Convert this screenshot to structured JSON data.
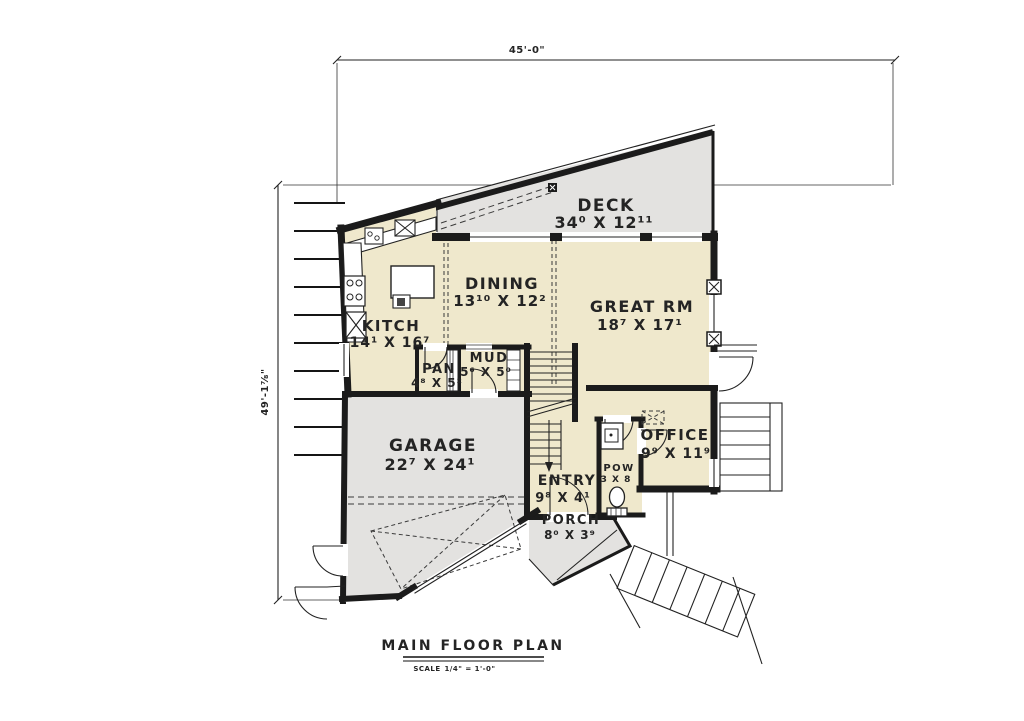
{
  "colors": {
    "background": "#ffffff",
    "interior": "#efe8cc",
    "concrete": "#e3e2e0",
    "wall": "#1b1b1b",
    "text": "#242424",
    "dash": "#3a3a3a"
  },
  "dimensions": {
    "top": "45'-0\"",
    "left": "49'-1⅞\""
  },
  "rooms": {
    "deck": {
      "name": "DECK",
      "dims": "34⁰ X 12¹¹"
    },
    "dining": {
      "name": "DINING",
      "dims": "13¹⁰ X 12²"
    },
    "great": {
      "name": "GREAT RM",
      "dims": "18⁷ X 17¹"
    },
    "kitchen": {
      "name": "KITCH",
      "dims": "14¹ X 16⁷"
    },
    "pantry": {
      "name": "PAN",
      "dims": "4⁸ X 5²"
    },
    "mud": {
      "name": "MUD",
      "dims": "5⁶ X 5⁰"
    },
    "garage": {
      "name": "GARAGE",
      "dims": "22⁷ X 24¹"
    },
    "office": {
      "name": "OFFICE",
      "dims": "9⁹ X 11⁹"
    },
    "entry": {
      "name": "ENTRY",
      "dims": "9⁸ X 4¹"
    },
    "powder": {
      "name": "POW",
      "dims": "3 X 8"
    },
    "porch": {
      "name": "PORCH",
      "dims": "8⁰ X 3⁹"
    }
  },
  "title_block": {
    "title": "MAIN FLOOR PLAN",
    "scale_label": "SCALE",
    "scale_value": "1/4\" = 1'-0\""
  }
}
